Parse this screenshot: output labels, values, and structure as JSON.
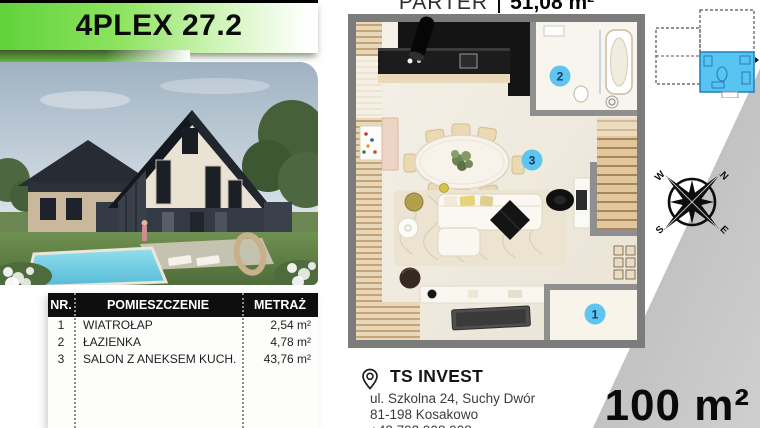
{
  "banner": {
    "title": "4PLEX 27.2"
  },
  "plan_header": {
    "floor_label": "PARTER",
    "area_value": "51,08 m²"
  },
  "room_table": {
    "columns": [
      "NR.",
      "POMIESZCZENIE",
      "METRAŻ"
    ],
    "rows": [
      {
        "nr": "1",
        "name": "WIATROŁAP",
        "area": "2,54 m²"
      },
      {
        "nr": "2",
        "name": "ŁAZIENKA",
        "area": "4,78 m²"
      },
      {
        "nr": "3",
        "name": "SALON Z ANEKSEM KUCH.",
        "area": "43,76 m²"
      }
    ]
  },
  "floor_plan": {
    "badges": [
      "1",
      "2",
      "3"
    ]
  },
  "compass": {
    "n": "N",
    "e": "E",
    "s": "S",
    "w": "W"
  },
  "contact": {
    "company": "TS INVEST",
    "address_line1": "ul. Szkolna 24, Suchy Dwór",
    "address_line2": "81-198 Kosakowo",
    "phone": "+48 792 908 908"
  },
  "footer": {
    "total_area": "100 m²"
  },
  "colors": {
    "accent_green": "#6fd24e",
    "badge_blue": "#5ec4f0",
    "unit_highlight_blue": "#57c4f2",
    "wedge_gray": "#a7a7a7"
  }
}
